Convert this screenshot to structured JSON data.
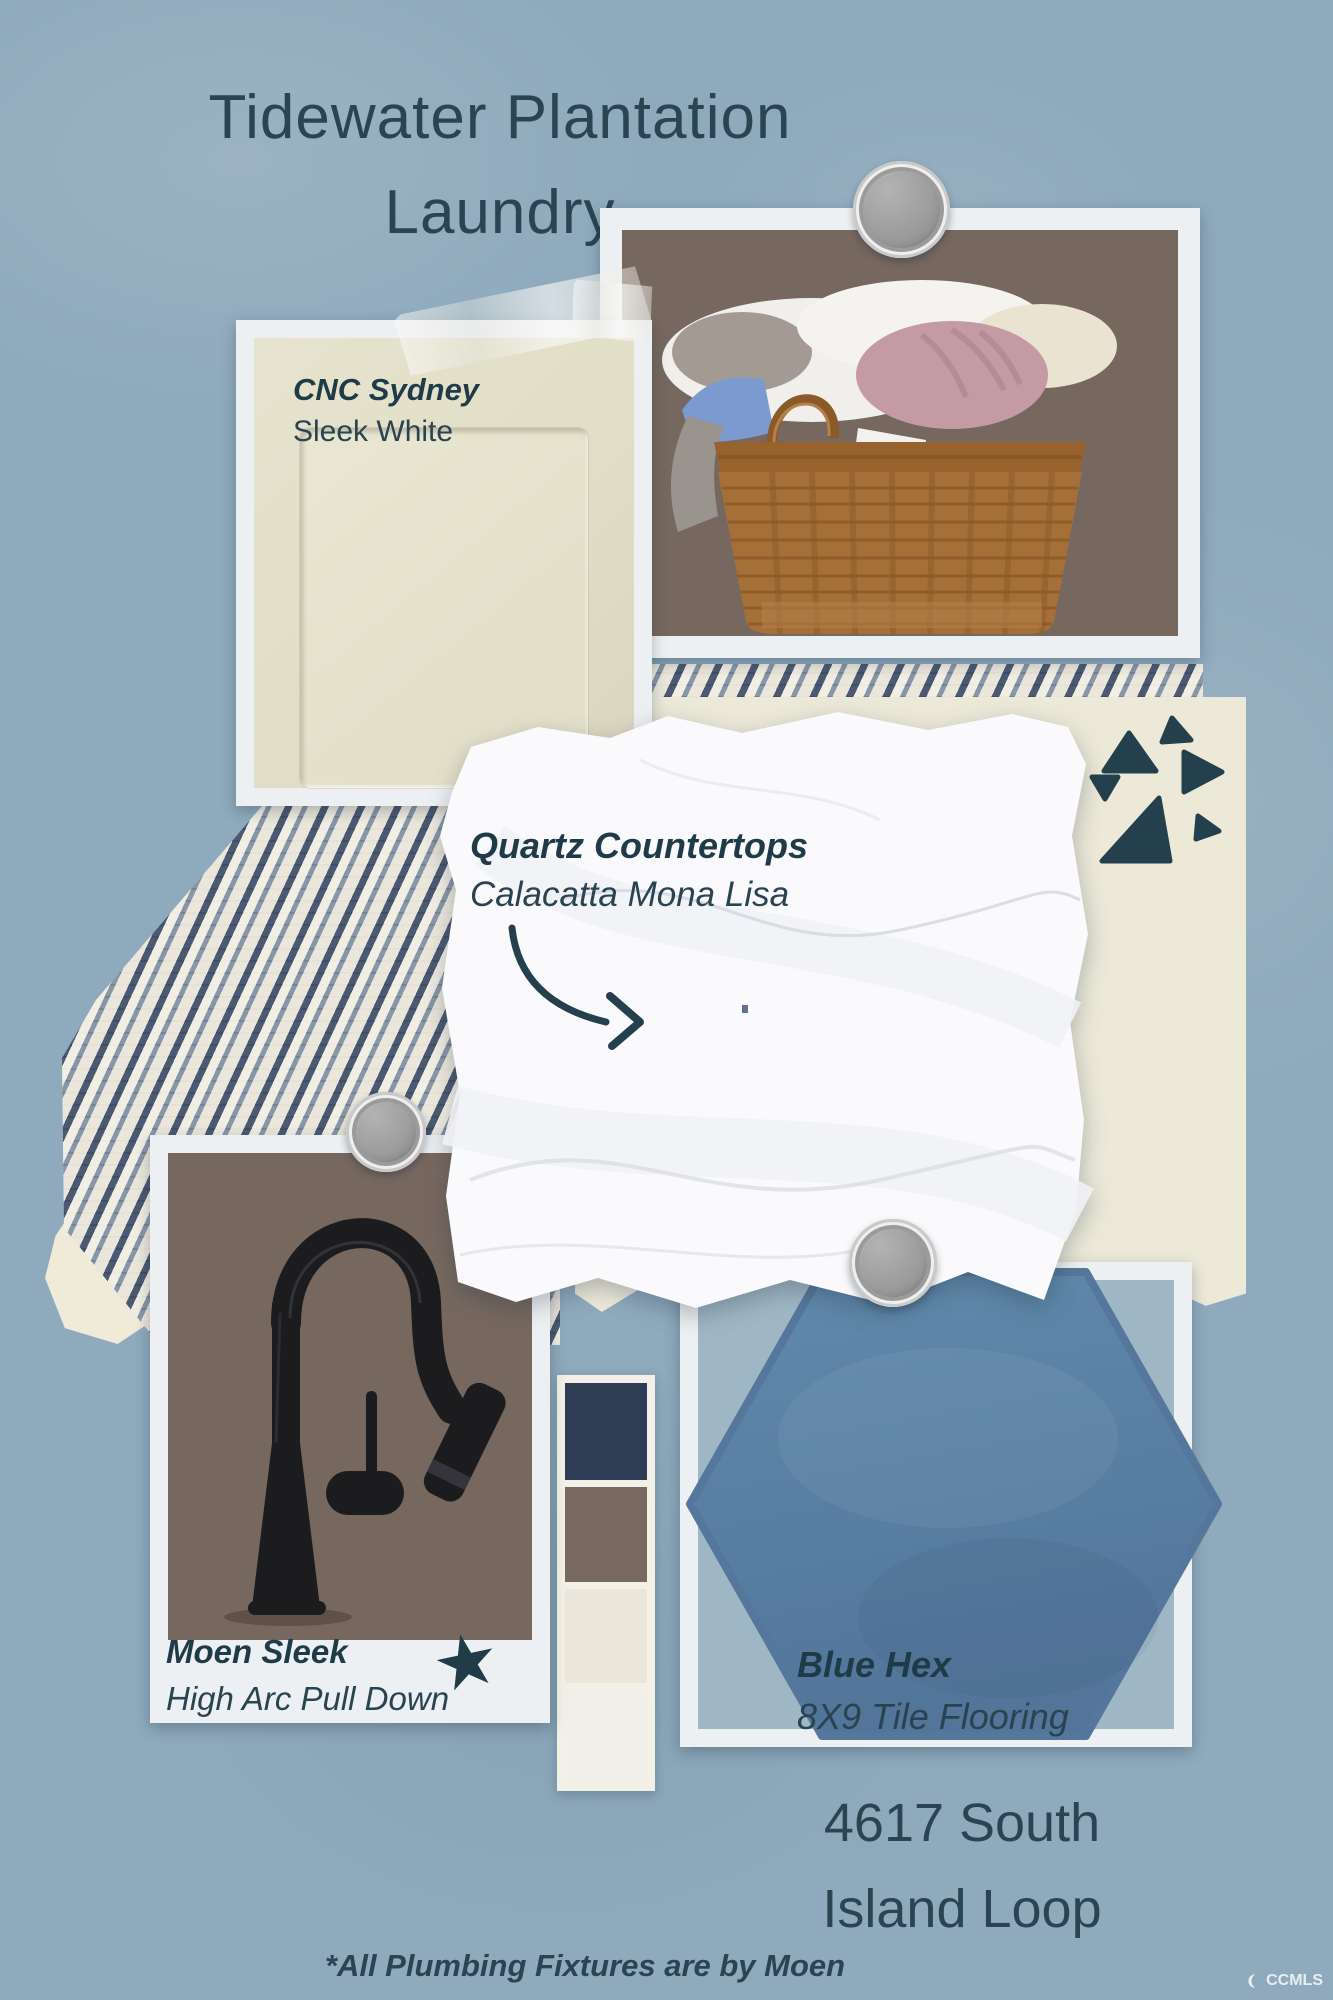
{
  "board": {
    "title": {
      "line1": "Tidewater Plantation",
      "line2": "Laundry"
    },
    "address": {
      "line1": "4617 South",
      "line2": "Island Loop"
    },
    "footnote": "*All Plumbing Fixtures are by Moen",
    "watermark": "CCMLS"
  },
  "samples": {
    "cabinet": {
      "name": "CNC Sydney",
      "finish": "Sleek White"
    },
    "countertop": {
      "name": "Quartz Countertops",
      "finish": "Calacatta Mona Lisa"
    },
    "faucet": {
      "name": "Moen Sleek",
      "finish": "High Arc Pull Down"
    },
    "tile": {
      "name": "Blue Hex",
      "finish": "8X9 Tile Flooring"
    }
  },
  "palette": {
    "navy": "#2E3C54",
    "brown": "#77695F",
    "cream": "#EAE6DA",
    "offwhite": "#F0EFE9"
  },
  "colors": {
    "background": "#8FAABD",
    "ink": "#2A4551",
    "card_white": "#EDF0F2",
    "photo_brown": "#77685F",
    "cabinet_cream": "#E3E0CA",
    "paper_cream": "#ECE9D9",
    "quartz_white": "#FAFAFC",
    "hex_tile_blue": "#587FA2",
    "hex_mat_blue": "#9FB6C4"
  },
  "icons": {
    "star": "★"
  }
}
